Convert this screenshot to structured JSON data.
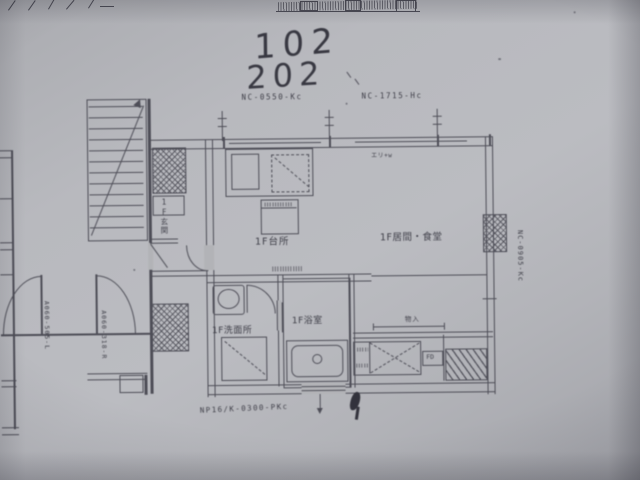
{
  "handwriting": {
    "unit_1": "102",
    "unit_2": "202"
  },
  "sash_codes": {
    "kitchen_window": "NC-0550-Kc",
    "living_window": "NC-1715-Hc",
    "side_window": "NC-0905-Kc",
    "entry_door": "NP16/K-0300-PKc"
  },
  "door_codes": {
    "left_outer": "A060-505-L",
    "left_inner": "A060-318-R"
  },
  "rooms": {
    "kitchen": "1F台所",
    "living_dining": "1F居間・食堂",
    "washroom": "1F洗面所",
    "bathroom": "1F浴室",
    "entrance": "1F玄関"
  },
  "annotations": {
    "closet": "物入",
    "fire_damper": "FD",
    "sleeve": "エリ+w"
  }
}
